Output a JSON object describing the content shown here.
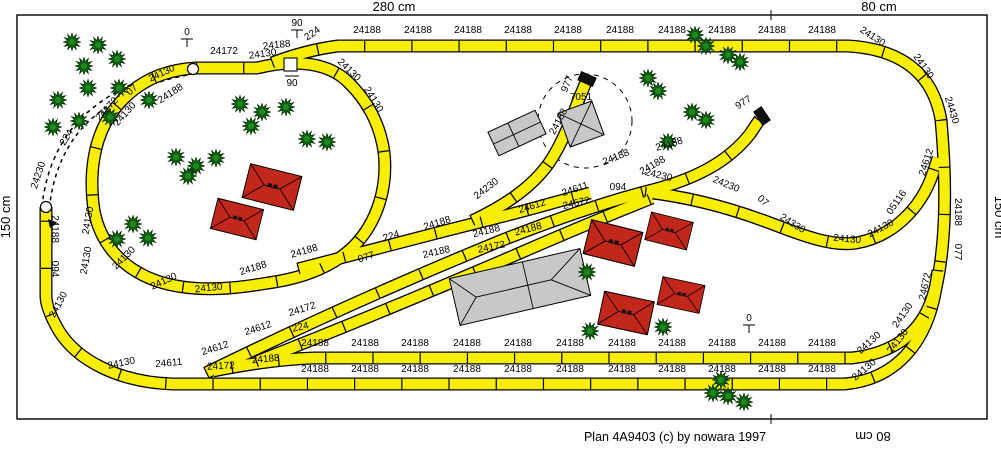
{
  "plan": {
    "caption": "Plan 4A9403  (c) by nowara 1997"
  },
  "dimensions": {
    "top_main": "280 cm",
    "top_right": "80 cm",
    "left": "150 cm",
    "right": "150 cm",
    "bottom_right": "80 cm"
  },
  "colors": {
    "track_yellow": "#f8ee00",
    "tree_green": "#157815",
    "roof_red": "#c1271b",
    "building_gray": "#c8c8c8",
    "buffer_black": "#111111"
  },
  "height_markers": [
    {
      "text": "0",
      "x": 187,
      "y": 35,
      "style": "tee"
    },
    {
      "text": "90",
      "x": 297,
      "y": 26,
      "style": "tee"
    },
    {
      "text": "90",
      "x": 292,
      "y": 86,
      "style": "over"
    },
    {
      "text": "0",
      "x": 749,
      "y": 321,
      "style": "tee"
    }
  ],
  "track_labels": [
    [
      "24188",
      367,
      33,
      0
    ],
    [
      "24188",
      418,
      33,
      0
    ],
    [
      "24188",
      468,
      33,
      0
    ],
    [
      "24188",
      518,
      33,
      0
    ],
    [
      "24188",
      568,
      33,
      0
    ],
    [
      "24188",
      620,
      33,
      0
    ],
    [
      "24188",
      672,
      33,
      0
    ],
    [
      "24188",
      722,
      33,
      0
    ],
    [
      "24188",
      772,
      33,
      0
    ],
    [
      "24188",
      822,
      33,
      0
    ],
    [
      "24130",
      871,
      39,
      33
    ],
    [
      "24130",
      921,
      68,
      55
    ],
    [
      "24430",
      949,
      111,
      73
    ],
    [
      "24612",
      929,
      163,
      -72
    ],
    [
      "24188",
      955,
      212,
      90
    ],
    [
      "077",
      955,
      252,
      90
    ],
    [
      "24672",
      928,
      287,
      -78
    ],
    [
      "24230",
      658,
      178,
      13
    ],
    [
      "24230",
      725,
      187,
      22
    ],
    [
      "07",
      761,
      203,
      42
    ],
    [
      "24330",
      791,
      226,
      32
    ],
    [
      "24130",
      847,
      242,
      5
    ],
    [
      "24130",
      882,
      231,
      -28
    ],
    [
      "05116",
      899,
      204,
      -55
    ],
    [
      "24130",
      905,
      317,
      -55
    ],
    [
      "24130",
      871,
      345,
      -42
    ],
    [
      "24130",
      900,
      343,
      -52
    ],
    [
      "24130",
      866,
      372,
      -40
    ],
    [
      "24188",
      315,
      346,
      0
    ],
    [
      "24188",
      365,
      346,
      0
    ],
    [
      "24188",
      415,
      346,
      0
    ],
    [
      "24188",
      467,
      346,
      0
    ],
    [
      "24188",
      518,
      346,
      0
    ],
    [
      "24188",
      570,
      346,
      0
    ],
    [
      "24188",
      622,
      346,
      0
    ],
    [
      "24188",
      672,
      346,
      0
    ],
    [
      "24188",
      722,
      346,
      0
    ],
    [
      "24188",
      772,
      346,
      0
    ],
    [
      "24188",
      822,
      346,
      0
    ],
    [
      "24188",
      315,
      372,
      0
    ],
    [
      "24188",
      365,
      372,
      0
    ],
    [
      "24188",
      415,
      372,
      0
    ],
    [
      "24188",
      467,
      372,
      0
    ],
    [
      "24188",
      518,
      372,
      0
    ],
    [
      "24188",
      570,
      372,
      0
    ],
    [
      "24188",
      622,
      372,
      0
    ],
    [
      "24188",
      672,
      372,
      0
    ],
    [
      "24188",
      722,
      372,
      0
    ],
    [
      "24188",
      772,
      372,
      0
    ],
    [
      "24188",
      822,
      372,
      0
    ],
    [
      "24130",
      122,
      366,
      -12
    ],
    [
      "24611",
      169,
      366,
      -5
    ],
    [
      "24172",
      221,
      369,
      -3
    ],
    [
      "24188",
      266,
      362,
      -5
    ],
    [
      "24612",
      216,
      351,
      -17
    ],
    [
      "24612",
      259,
      331,
      -18
    ],
    [
      "24172",
      303,
      312,
      -17
    ],
    [
      "224",
      301,
      330,
      -13
    ],
    [
      "24188",
      254,
      271,
      -17
    ],
    [
      "24188",
      305,
      254,
      -16
    ],
    [
      "077",
      367,
      260,
      -17
    ],
    [
      "224",
      392,
      239,
      -17
    ],
    [
      "24188",
      438,
      226,
      -17
    ],
    [
      "24188",
      437,
      255,
      -13
    ],
    [
      "24172",
      492,
      250,
      -12
    ],
    [
      "24188",
      487,
      234,
      -14
    ],
    [
      "24188",
      529,
      232,
      -15
    ],
    [
      "24612",
      533,
      209,
      -17
    ],
    [
      "24611",
      576,
      192,
      -18
    ],
    [
      "24672",
      577,
      206,
      -13
    ],
    [
      "094",
      618,
      190,
      0
    ],
    [
      "24188",
      617,
      160,
      -22
    ],
    [
      "24188",
      670,
      147,
      -16
    ],
    [
      "24230",
      488,
      191,
      -38
    ],
    [
      "24188",
      561,
      123,
      -62
    ],
    [
      "24188",
      654,
      168,
      -30
    ],
    [
      "977",
      570,
      85,
      -68
    ],
    [
      "7051",
      581,
      100,
      0
    ],
    [
      "977",
      745,
      105,
      -33
    ],
    [
      "24172",
      224,
      54,
      0
    ],
    [
      "24130",
      263,
      57,
      -8
    ],
    [
      "24188",
      277,
      48,
      -6
    ],
    [
      "224",
      314,
      36,
      -35
    ],
    [
      "24130",
      347,
      72,
      44
    ],
    [
      "24130",
      371,
      101,
      58
    ],
    [
      "24188",
      172,
      96,
      -33
    ],
    [
      "24130",
      127,
      116,
      -48
    ],
    [
      "24130",
      91,
      221,
      -80
    ],
    [
      "24130",
      89,
      261,
      -80
    ],
    [
      "24130",
      126,
      260,
      -45
    ],
    [
      "24130",
      165,
      284,
      -25
    ],
    [
      "24130",
      209,
      291,
      -6
    ],
    [
      "24230",
      41,
      176,
      -72
    ],
    [
      "224",
      69,
      139,
      -58
    ],
    [
      "24172",
      109,
      111,
      -47
    ],
    [
      "07",
      134,
      92,
      -43
    ],
    [
      "24130",
      163,
      76,
      -25
    ],
    [
      "24188",
      52,
      229,
      90
    ],
    [
      "094",
      52,
      269,
      90
    ],
    [
      "24130",
      61,
      306,
      -62
    ]
  ]
}
